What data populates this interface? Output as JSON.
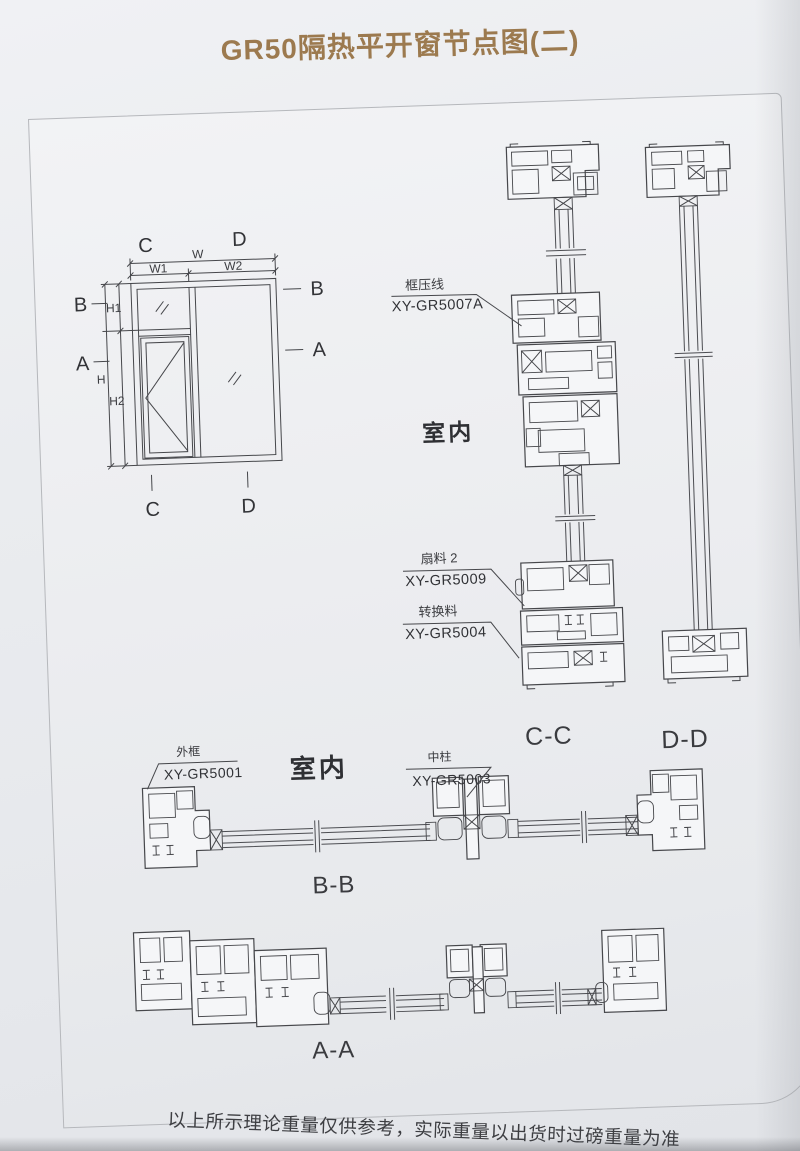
{
  "page": {
    "title": "GR50隔热平开窗节点图(二)",
    "footer": "以上所示理论重量仅供参考，实际重量以出货时过磅重量为准"
  },
  "elevation": {
    "top": {
      "left": "C",
      "right": "D"
    },
    "bottom": {
      "left": "C",
      "right": "D"
    },
    "side_left": {
      "top": "B",
      "mid": "A"
    },
    "side_right": {
      "top": "B",
      "mid": "A"
    },
    "dims": {
      "w": "W",
      "w1": "W1",
      "w2": "W2",
      "h": "H",
      "h1": "H1",
      "h2": "H2"
    }
  },
  "sections": {
    "cc": "C-C",
    "dd": "D-D",
    "bb": "B-B",
    "aa": "A-A"
  },
  "ann": {
    "frame_bead": {
      "name": "框压线",
      "code": "XY-GR5007A"
    },
    "sash2": {
      "name": "扇料 2",
      "code": "XY-GR5009"
    },
    "adapter": {
      "name": "转换料",
      "code": "XY-GR5004"
    },
    "outer_frame": {
      "name": "外框",
      "code": "XY-GR5001"
    },
    "mullion": {
      "name": "中柱",
      "code": "XY-GR5003"
    },
    "indoor_upper": "室内",
    "indoor_lower": "室内"
  }
}
